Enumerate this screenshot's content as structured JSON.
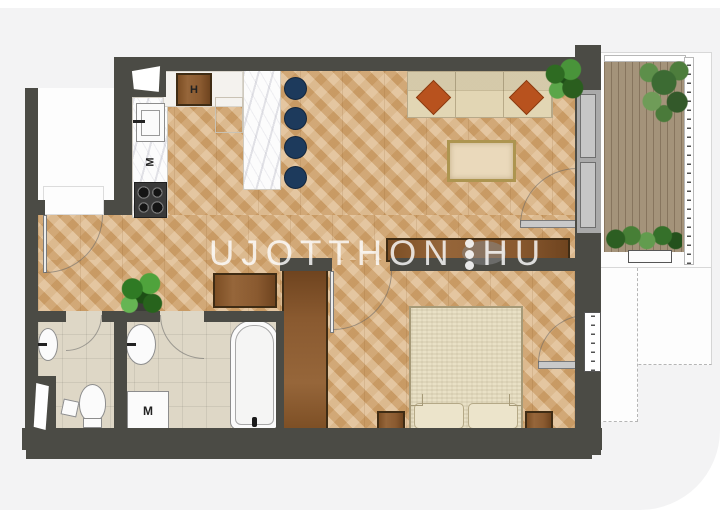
{
  "watermark": {
    "name_left": "UJOTTHON",
    "name_right": "HU"
  },
  "appliance_labels": {
    "fridge": "H",
    "dishwasher": "M",
    "washing_machine": "M"
  },
  "colors": {
    "background_card": "#f3f3f4",
    "wall": "#4b4b45",
    "wood_floor": "#d9ae79",
    "terrace_deck": "#a4937a",
    "bath_tile": "#ded7c6",
    "stool_navy": "#1d3a5c",
    "pillow_rust": "#b8521e",
    "furniture_brown": "#8a5a30",
    "sofa_bed_beige": "#e2d6b4",
    "watermark_text": "#fdfdfd"
  }
}
